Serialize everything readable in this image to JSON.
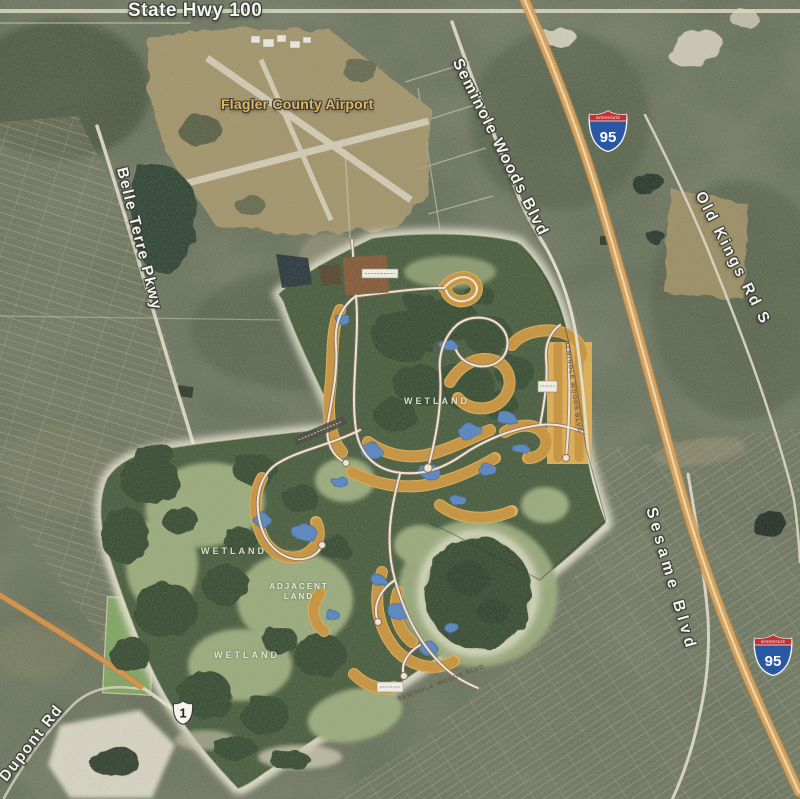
{
  "map_title": "Aerial development master plan map",
  "labels": {
    "state_hwy_100": "State Hwy 100",
    "flagler_county_airport": "Flagler County Airport",
    "seminole_woods_blvd": "Seminole Woods Blvd",
    "old_kings_rd_s": "Old Kings Rd S",
    "belle_terre_pkwy": "Belle Terre Pkwy",
    "sesame_blvd": "Sesame Blvd",
    "dupont_rd": "Dupont Rd",
    "wetland_north": "WETLAND",
    "wetland_west": "WETLAND",
    "wetland_south": "WETLAND",
    "adjacent_land_line1": "ADJACENT",
    "adjacent_land_line2": "LAND",
    "seminole_woods_blvd_onroad_east": "SEMINOLE WOODS BLVD",
    "seminole_woods_blvd_onroad_south": "SEMINOLE WOODS BLVD"
  },
  "shields": {
    "interstate_north": {
      "band": "INTERSTATE",
      "number": "95"
    },
    "interstate_south": {
      "band": "INTERSTATE",
      "number": "95"
    },
    "us_route_1": {
      "number": "1"
    }
  },
  "colors": {
    "highway_orange": "#de9b47",
    "road_pale": "#ddd7c3",
    "parcel_gold": "#e2ab49",
    "parcel_tick_orange": "#b97b24",
    "pond_blue": "#4e7ec2",
    "forest_dark_green": "#2e4128",
    "meadow_sage": "#97a877",
    "site_glow_white": "#f4efdd",
    "shield_blue": "#2957a4",
    "shield_red": "#c53030",
    "airport_label_gold": "#dfb662",
    "label_white": "#f4f4ee"
  }
}
